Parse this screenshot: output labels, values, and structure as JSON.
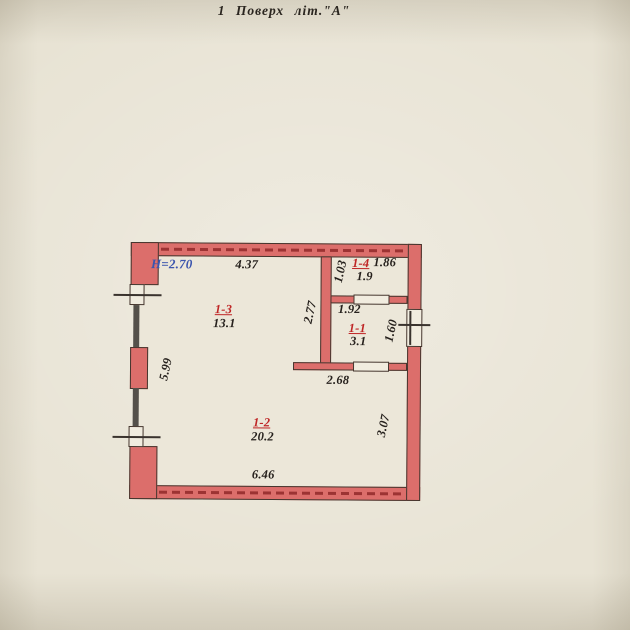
{
  "title": "1  Поверх  літ.\"А\"",
  "plan": {
    "height_note": "Н=2.70",
    "rooms": [
      {
        "id": "1-3",
        "area": "13.1"
      },
      {
        "id": "1-4",
        "area": "1.9"
      },
      {
        "id": "1-1",
        "area": "3.1"
      },
      {
        "id": "1-2",
        "area": "20.2"
      }
    ],
    "dims": {
      "top_width": "4.37",
      "r14_height": "1.03",
      "r14_width": "1.86",
      "corridor_height": "2.77",
      "r11_width": "1.92",
      "r11_height": "1.60",
      "hall_width": "2.68",
      "left_height": "5.99",
      "right_height": "3.07",
      "bottom_width": "6.46"
    }
  },
  "colors": {
    "paper": "#e8e3d4",
    "wall_fill": "#dc6e6b",
    "wall_dash": "#9c3333",
    "wall_outline": "#45362e",
    "dark_wall": "#54504a",
    "room_label": "#bf2626",
    "height_note": "#3b55ae",
    "dim_text": "#26211d"
  }
}
